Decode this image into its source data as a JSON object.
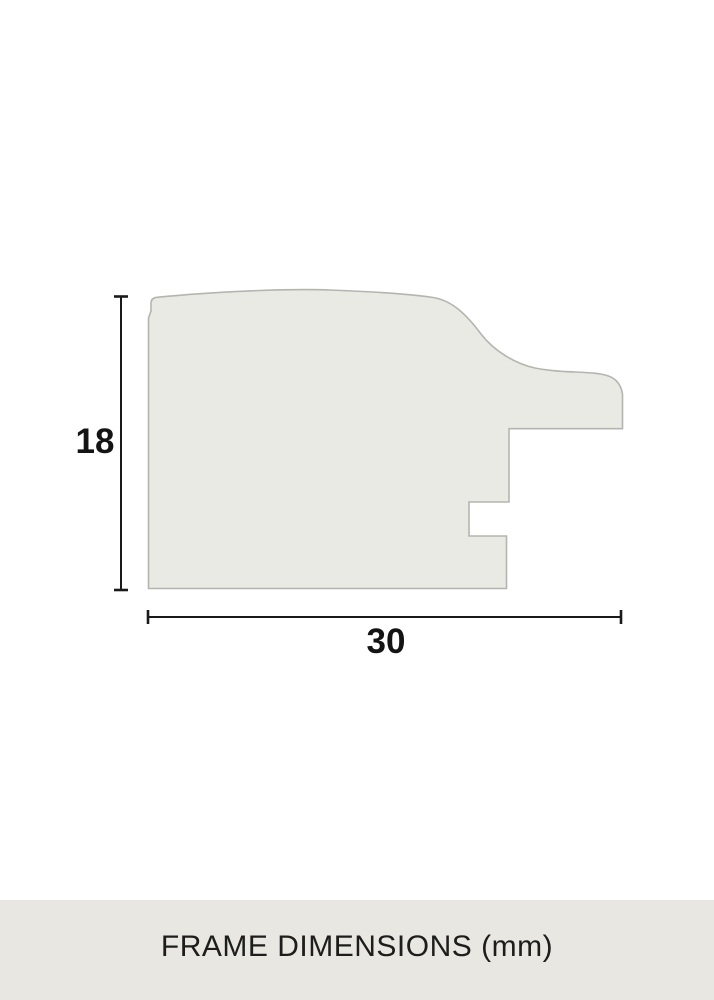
{
  "diagram": {
    "title_semantic": "frame-moulding-profile-cross-section",
    "height_dimension": {
      "value": "18",
      "orientation": "vertical"
    },
    "width_dimension": {
      "value": "30",
      "orientation": "horizontal"
    }
  },
  "footer": {
    "caption": "FRAME DIMENSIONS (mm)"
  },
  "colors": {
    "canvas_bg": "#ffffff",
    "profile_fill": "#eaeae5",
    "profile_stroke": "#b5b5af",
    "dimension_line": "#1a1a1a",
    "label_text": "#141414",
    "footer_bg": "#e8e7e2",
    "footer_text": "#1d1d1b"
  }
}
